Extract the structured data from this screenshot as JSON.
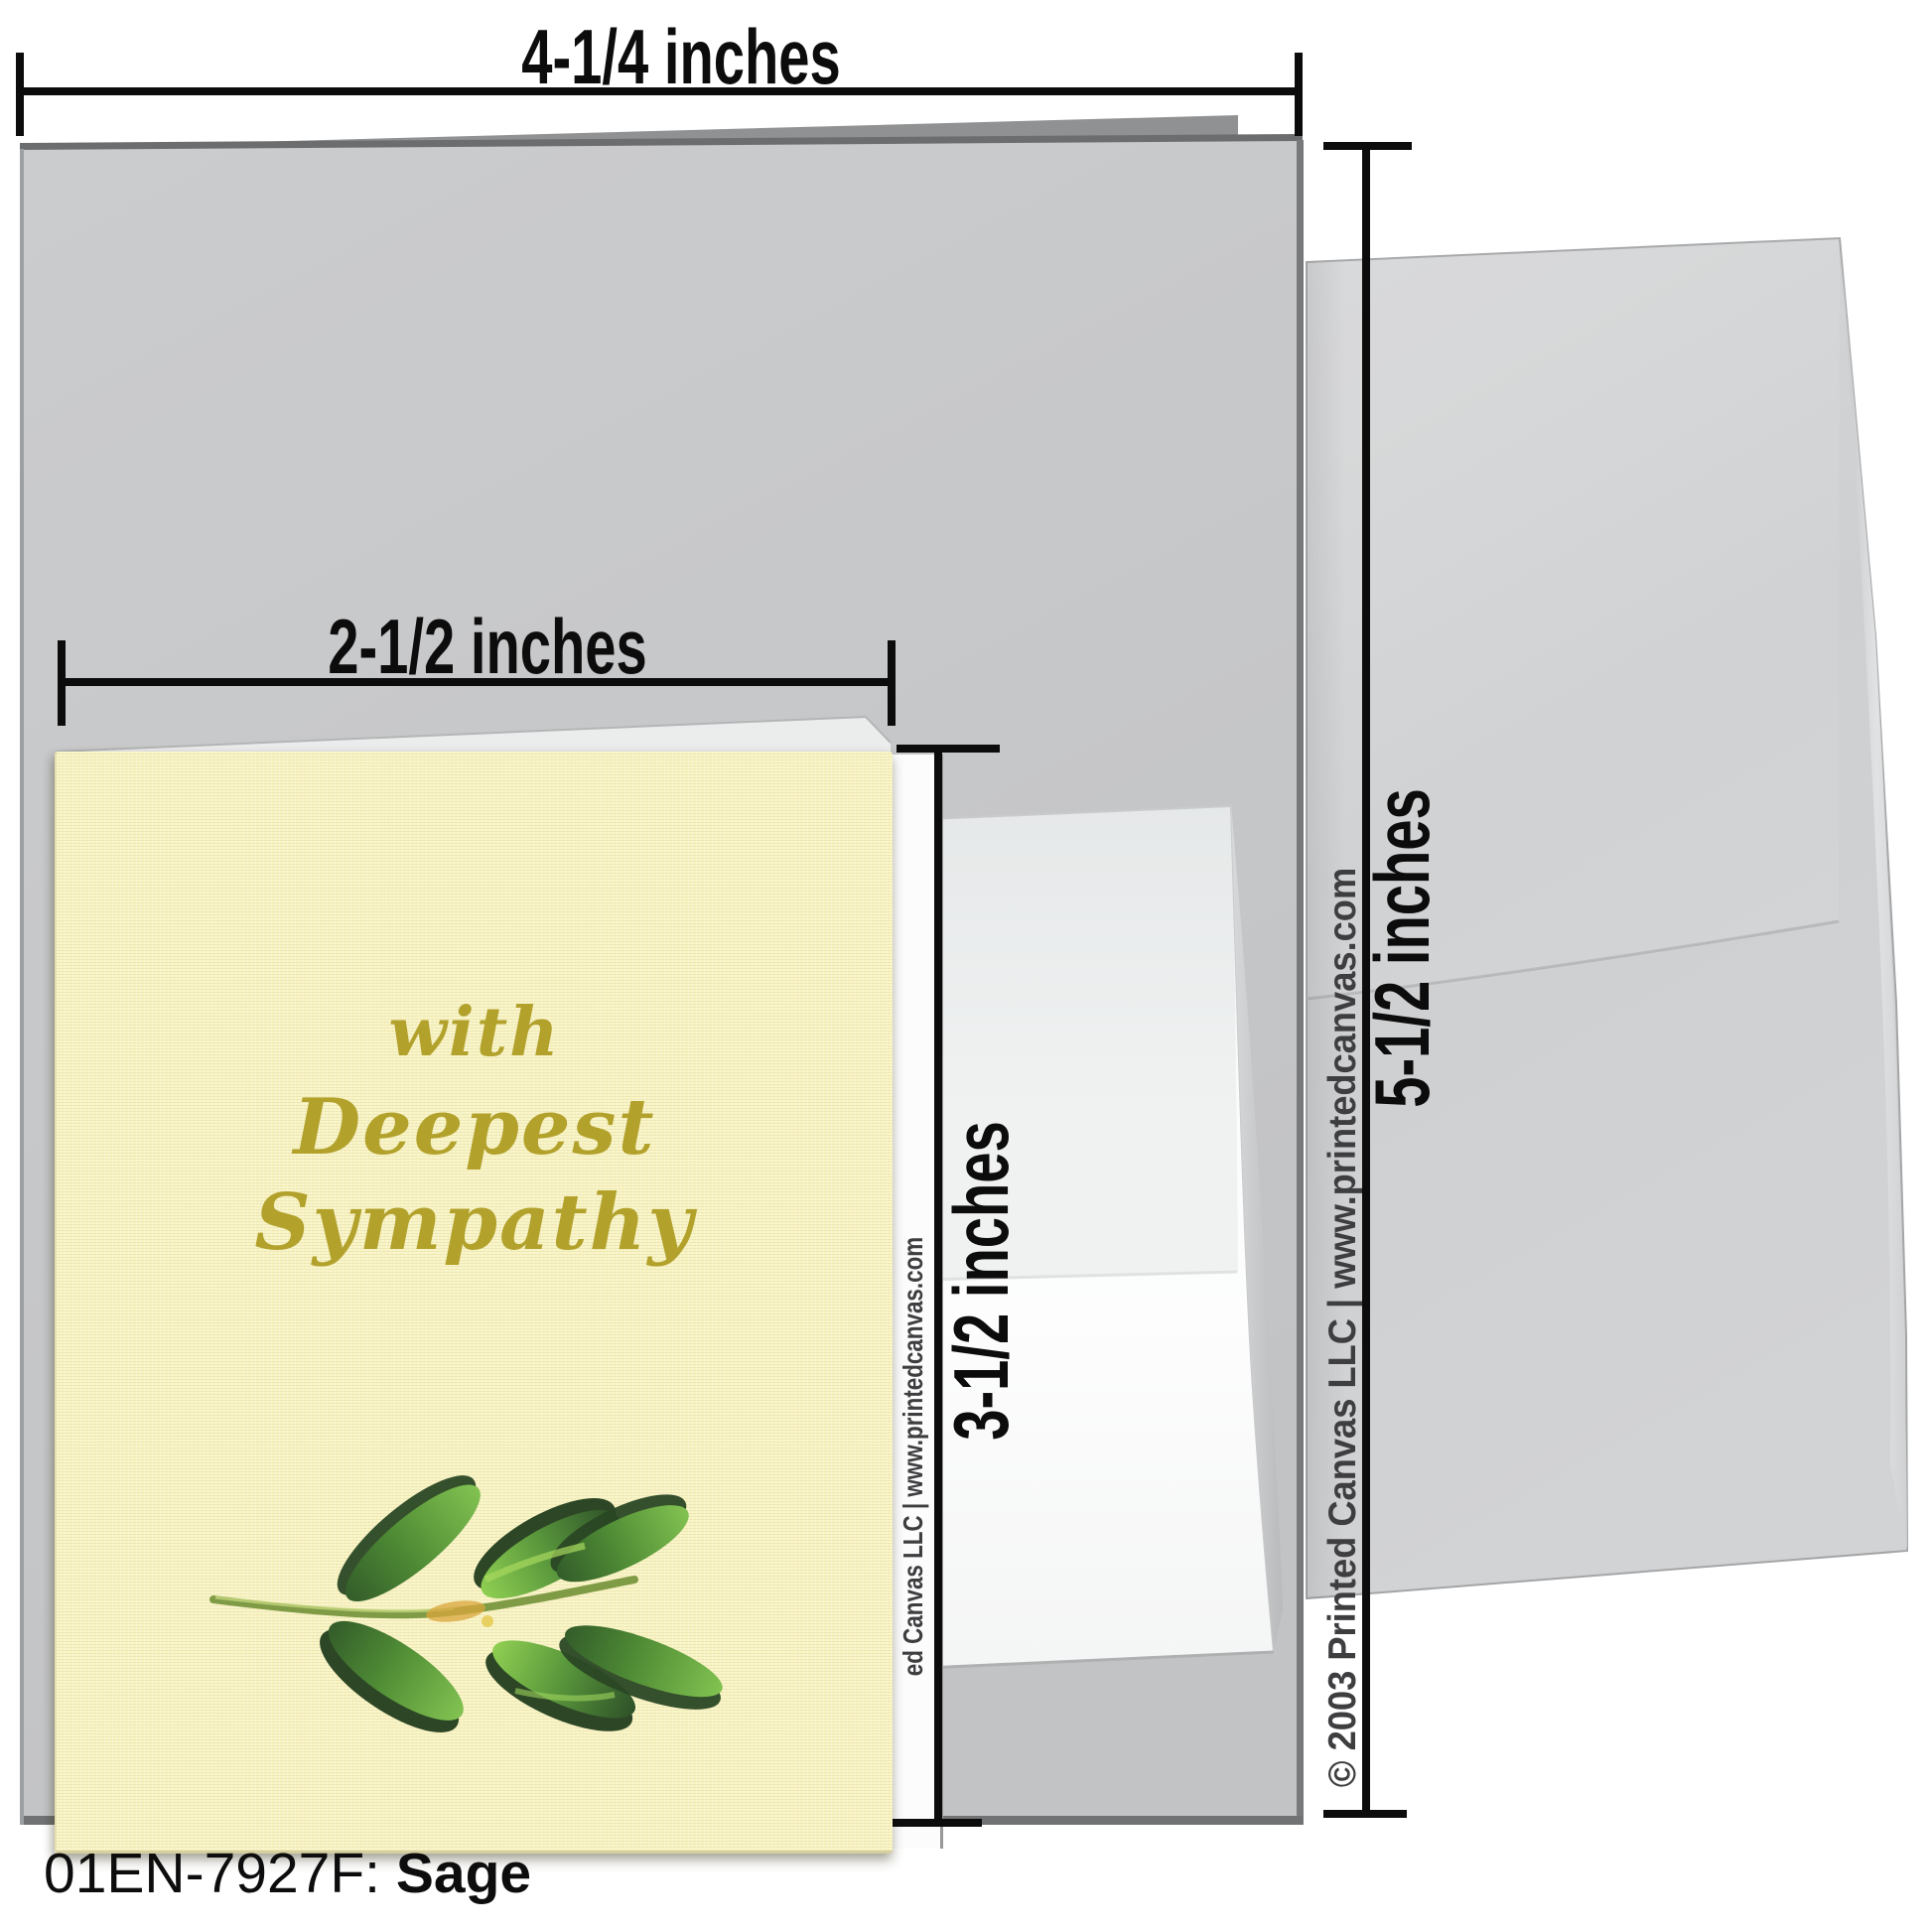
{
  "dimensions": {
    "overall_width": "4-1/4 inches",
    "card_width": "2-1/2 inches",
    "card_height": "3-1/2 inches",
    "envelope_height": "5-1/2 inches"
  },
  "card_front": {
    "message_line1": "with",
    "message_line2": "Deepest",
    "message_line3": "Sympathy"
  },
  "branding": {
    "copyright_full": "© 2003 Printed Canvas LLC | www.printedcanvas.com",
    "copyright_partial": "ed Canvas LLC | www.printedcanvas.com"
  },
  "footer": {
    "sku": "01EN-7927F:",
    "product_name": "Sage"
  },
  "icons": {
    "sage_branch": "sage-branch-illustration"
  },
  "colors": {
    "card_cream": "#f9f4c5",
    "script_gold": "#b2a12b",
    "card_gray": "#c7c8ca",
    "envelope_gray": "#d0d2d4",
    "envelope_white": "#fafbfb",
    "dimension_black": "#0c0c0c",
    "copyright_gray": "#3e3e40",
    "leaf_green_dark": "#2a4724",
    "leaf_green_mid": "#4f8c35",
    "leaf_green_light": "#82c251",
    "stem_olive": "#7f9b45",
    "stem_accent_orange": "#d9a53c"
  }
}
